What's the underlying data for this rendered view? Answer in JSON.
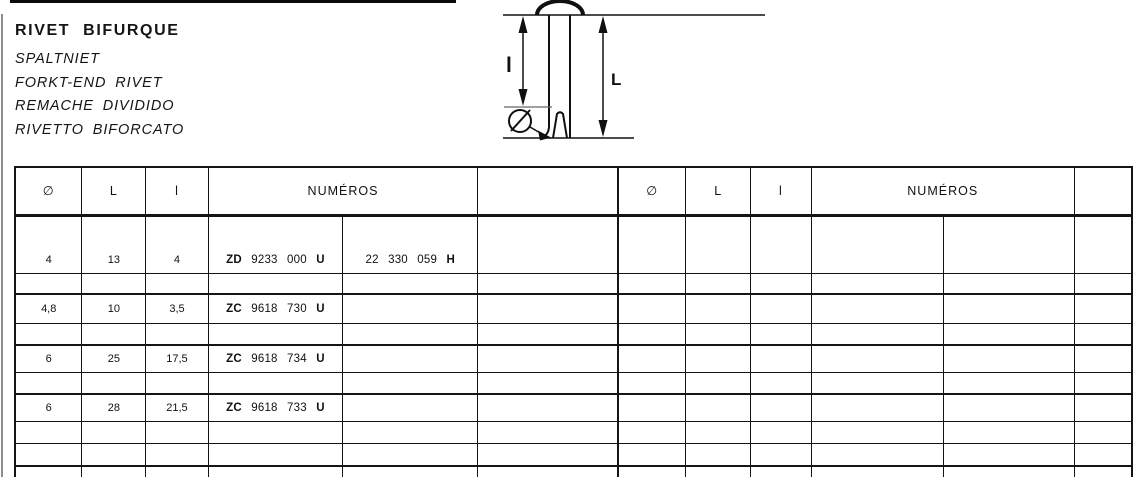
{
  "header": {
    "title": "RIVET BIFURQUE",
    "subtitles": [
      "SPALTNIET",
      "FORKT-END RIVET",
      "REMACHE DIVIDIDO",
      "RIVETTO BIFORCATO"
    ]
  },
  "diagram": {
    "label_inner": "l",
    "label_total": "L"
  },
  "table": {
    "col_headers": {
      "diameter": "∅",
      "total_length": "L",
      "inner_length": "l",
      "numbers": "NUMÉROS"
    },
    "rows": [
      {
        "type": "data",
        "tall": true,
        "diameter": "4",
        "L": "13",
        "l": "4",
        "num1": {
          "prefix": "ZD",
          "digits": "9233 000",
          "suffix": "U"
        },
        "num2": {
          "prefix": "",
          "digits": "22 330 059",
          "suffix": "H"
        }
      },
      {
        "type": "spacer"
      },
      {
        "type": "data",
        "diameter": "4,8",
        "L": "10",
        "l": "3,5",
        "num1": {
          "prefix": "ZC",
          "digits": "9618 730",
          "suffix": "U"
        },
        "num2": null
      },
      {
        "type": "spacer"
      },
      {
        "type": "data",
        "diameter": "6",
        "L": "25",
        "l": "17,5",
        "num1": {
          "prefix": "ZC",
          "digits": "9618 734",
          "suffix": "U"
        },
        "num2": null
      },
      {
        "type": "spacer"
      },
      {
        "type": "data",
        "diameter": "6",
        "L": "28",
        "l": "21,5",
        "num1": {
          "prefix": "ZC",
          "digits": "9618 733",
          "suffix": "U"
        },
        "num2": null
      },
      {
        "type": "spacer"
      },
      {
        "type": "spacer"
      },
      {
        "type": "spacer"
      }
    ]
  }
}
